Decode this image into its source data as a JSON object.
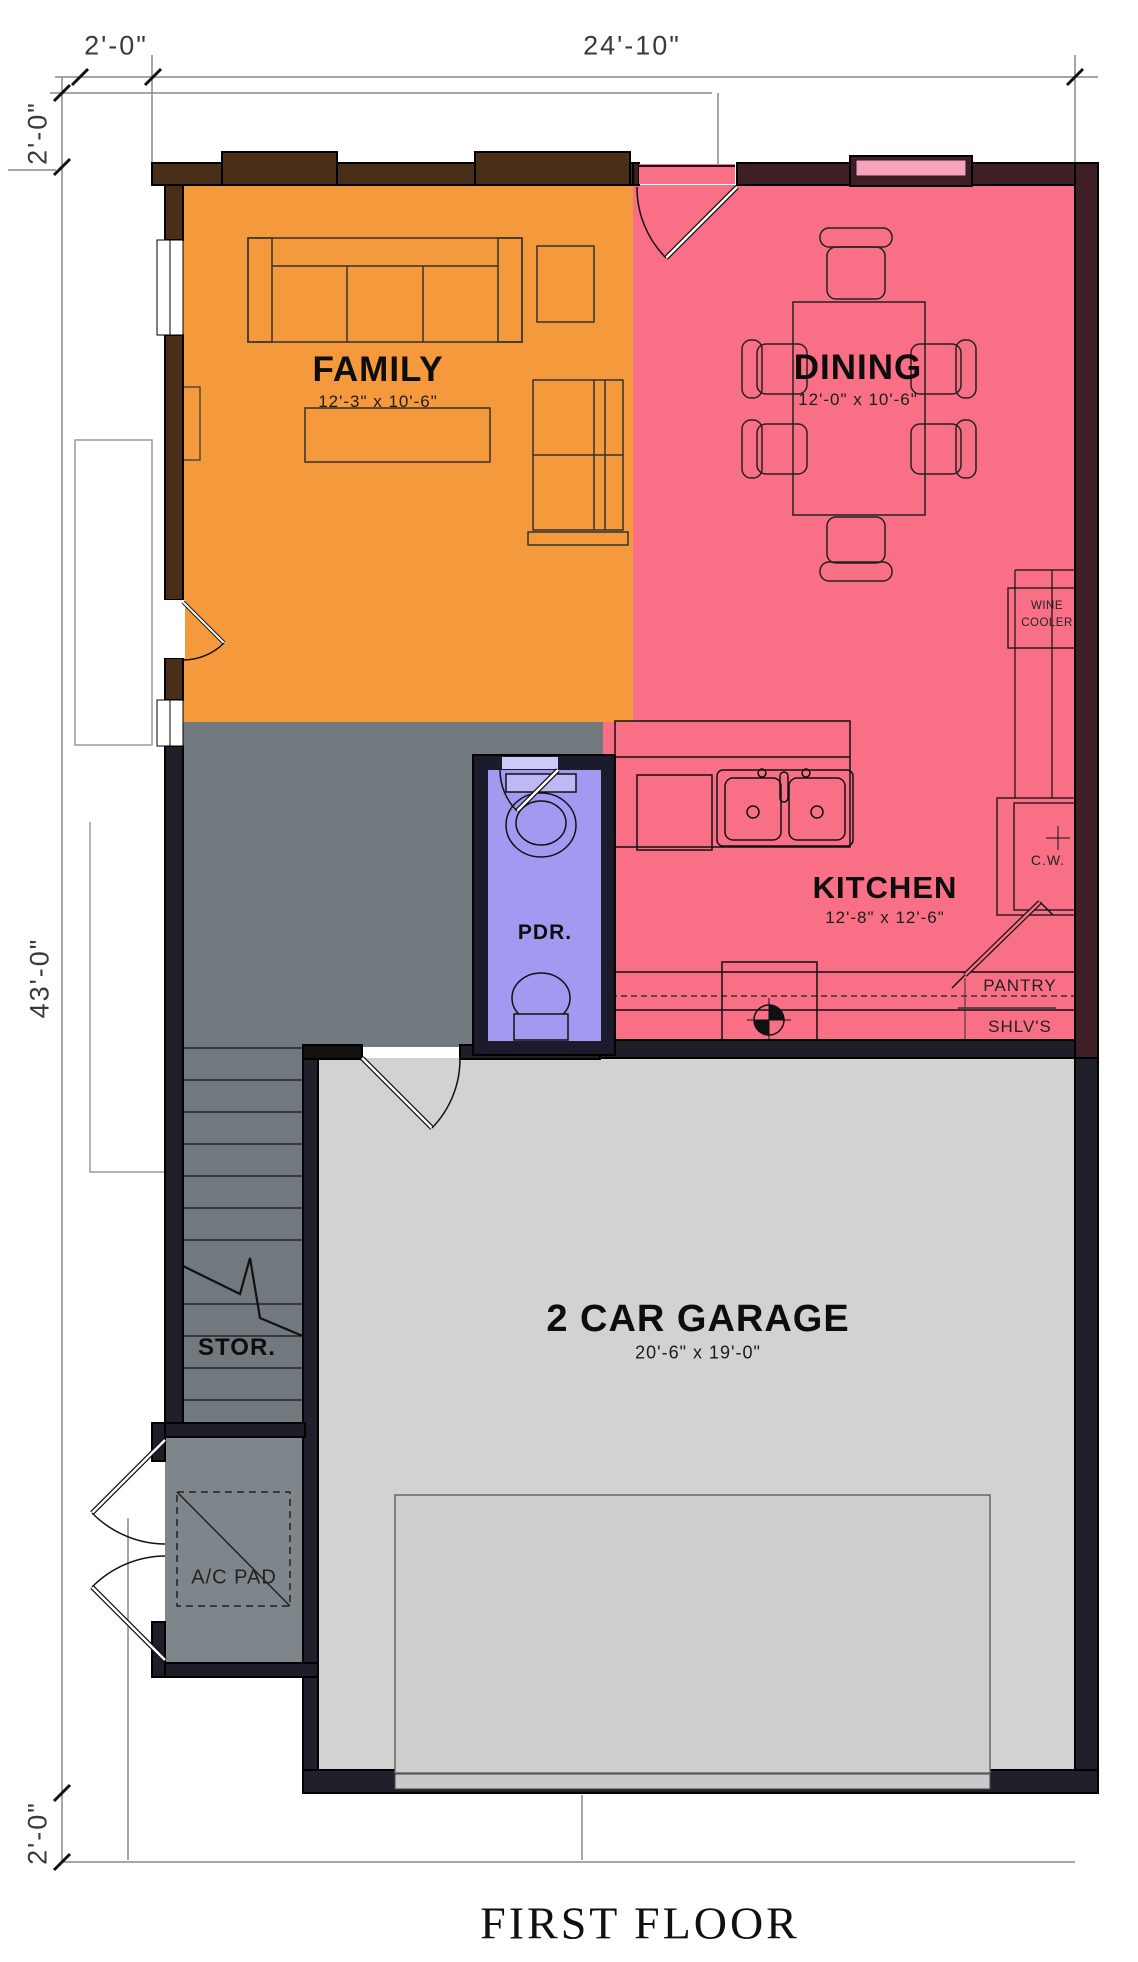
{
  "title": "FIRST FLOOR",
  "dimensions": {
    "top_offset": "2'-0\"",
    "top_width": "24'-10\"",
    "left_offset_top": "2'-0\"",
    "left_height": "43'-0\"",
    "left_offset_bottom": "2'-0\""
  },
  "rooms": {
    "family": {
      "name": "FAMILY",
      "size": "12'-3\" x 10'-6\""
    },
    "dining": {
      "name": "DINING",
      "size": "12'-0\" x 10'-6\""
    },
    "kitchen": {
      "name": "KITCHEN",
      "size": "12'-8\" x 12'-6\""
    },
    "garage": {
      "name": "2 CAR GARAGE",
      "size": "20'-6\" x 19'-0\""
    },
    "powder": {
      "name": "PDR."
    },
    "storage": {
      "name": "STOR."
    }
  },
  "fixtures": {
    "wine_cooler": "WINE COOLER",
    "cooler_abbr": "C.W.",
    "pantry": "PANTRY",
    "pantry_shelves": "SHLV'S",
    "ac_pad": "A/C PAD"
  },
  "colors": {
    "family": "#F59A3C",
    "dining_kitchen": "#F86F86",
    "hall": "#71787E",
    "powder": "#A29AF0",
    "garage": "#D2D2D2",
    "patio": "#7E868C",
    "wall_brown": "#4A2F18",
    "wall_maroon": "#3F1F26",
    "wall_dark": "#211F2A",
    "window_pink": "#F7A3BB"
  }
}
